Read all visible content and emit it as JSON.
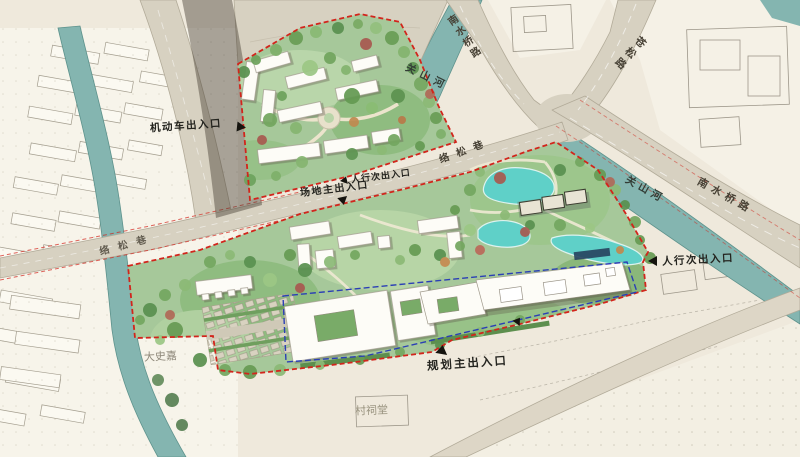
{
  "map": {
    "type": "site-master-plan",
    "labels": {
      "entrances": [
        {
          "text": "机动车出入口",
          "arrow": "right"
        },
        {
          "text": "人行次出入口",
          "arrow": "up"
        },
        {
          "text": "场地主出入口",
          "arrow": "down"
        },
        {
          "text": "人行次出入口",
          "arrow": "left"
        },
        {
          "text": "规划主出入口",
          "arrow": "up"
        }
      ],
      "roads": [
        "南水桥路",
        "苍松路",
        "络松巷",
        "络松巷",
        "南水桥路"
      ],
      "rivers": [
        "关山河",
        "关山河"
      ],
      "places": [
        "大史嘉",
        "村祠堂"
      ]
    },
    "colors": {
      "site_boundary_red": "#d2251c",
      "planning_boundary_blue": "#2b3fb5",
      "river_teal": "#84b5b0",
      "pond_cyan": "#5fd0c8",
      "road_beige": "#d7d1c1",
      "greenery": "#a6c89a",
      "building_white": "#fdfcf7",
      "basemap_cream": "#efe9dc"
    }
  }
}
